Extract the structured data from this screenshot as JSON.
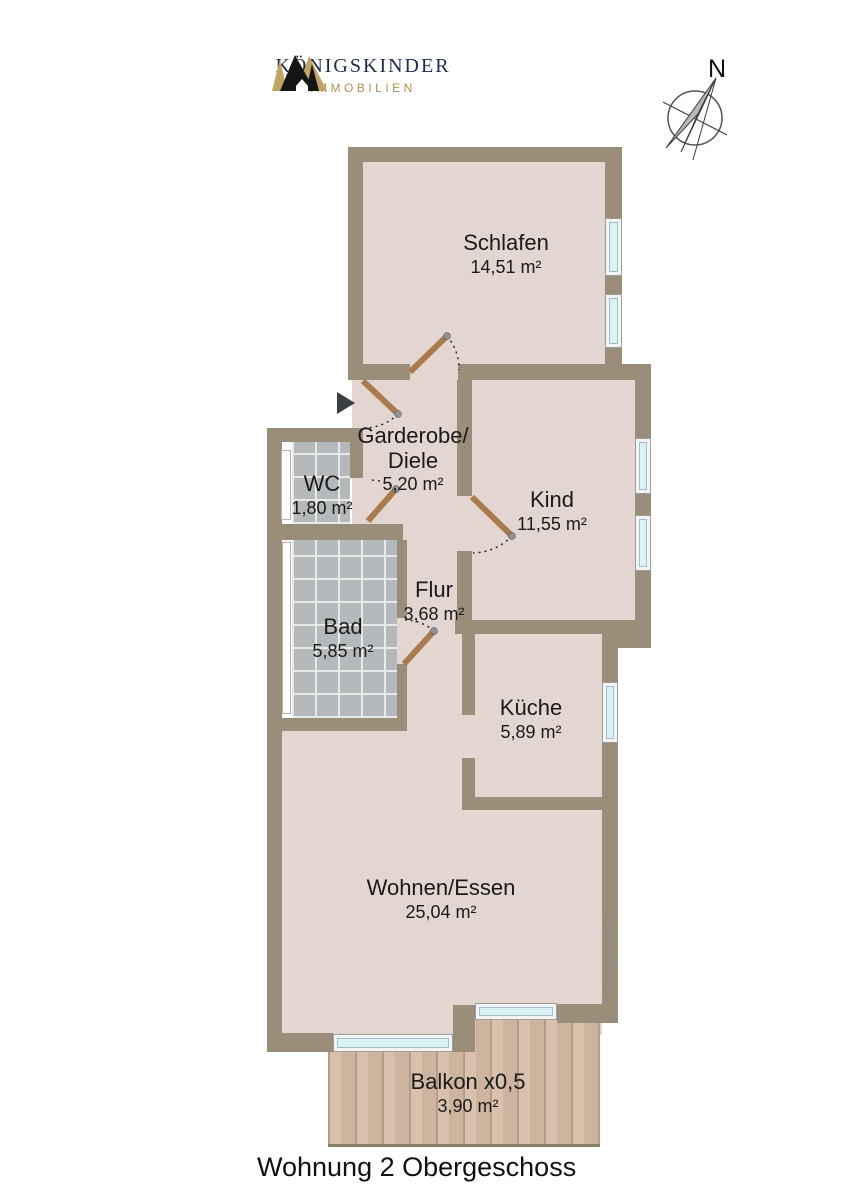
{
  "brand": {
    "name": "KÖNIGSKINDER",
    "tagline": "IMMOBILIEN"
  },
  "compass": {
    "north_label": "N"
  },
  "rooms": {
    "schlafen": {
      "name": "Schlafen",
      "area": "14,51 m²"
    },
    "garderobe": {
      "name_line1": "Garderobe/",
      "name_line2": "Diele",
      "area": "5,20 m²"
    },
    "wc": {
      "name": "WC",
      "area": "1,80 m²"
    },
    "kind": {
      "name": "Kind",
      "area": "11,55 m²"
    },
    "flur": {
      "name": "Flur",
      "area": "3,68 m²"
    },
    "bad": {
      "name": "Bad",
      "area": "5,85 m²"
    },
    "kueche": {
      "name": "Küche",
      "area": "5,89 m²"
    },
    "wohnen": {
      "name": "Wohnen/Essen",
      "area": "25,04 m²"
    },
    "balkon": {
      "name": "Balkon x0,5",
      "area": "3,90 m²"
    }
  },
  "watermark": "Immogrundriss",
  "caption": "Wohnung 2 Obergeschoss",
  "colors": {
    "wall": "#9a8d79",
    "floor": "#e3d5cf",
    "tile": "#b5b9bb",
    "wood": "#d4bba4",
    "window_glass": "#daf2f6",
    "door": "#a87a4e",
    "brand_navy": "#1f2b4d",
    "brand_gold": "#b3924f"
  }
}
